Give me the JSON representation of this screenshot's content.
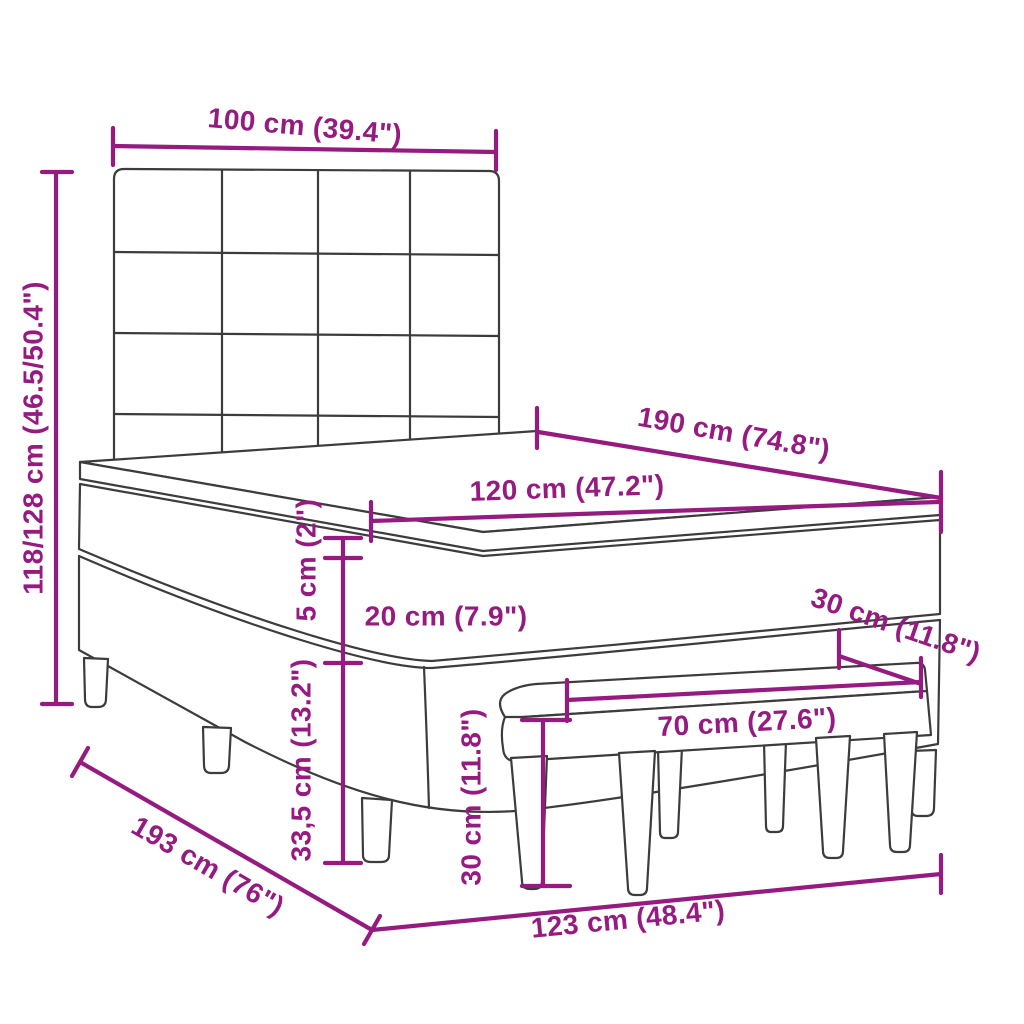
{
  "diagram": {
    "type": "furniture-dimension-line-drawing",
    "subject": "box spring bed with tufted headboard, mattress topper and upholstered bench",
    "background_color": "#ffffff",
    "accent_color": "#951b81",
    "line_color": "#3c3c3c"
  },
  "dimensions": {
    "headboard_width": {
      "label": "100 cm (39.4\")"
    },
    "total_height": {
      "label": "118/128 cm (46.5/50.4\")"
    },
    "bed_length": {
      "label": "190 cm (74.8\")"
    },
    "bed_width": {
      "label": "120 cm (47.2\")"
    },
    "topper_thickness": {
      "label": "5 cm (2\")"
    },
    "mattress_height": {
      "label": "20 cm (7.9\")"
    },
    "base_height": {
      "label": "33,5 cm (13.2\")"
    },
    "bench_depth": {
      "label": "30 cm (11.8\")"
    },
    "bench_length": {
      "label": "70 cm (27.6\")"
    },
    "bench_height": {
      "label": "30 cm (11.8\")"
    },
    "floor_depth": {
      "label": "193 cm (76\")"
    },
    "floor_width": {
      "label": "123 cm (48.4\")"
    }
  }
}
